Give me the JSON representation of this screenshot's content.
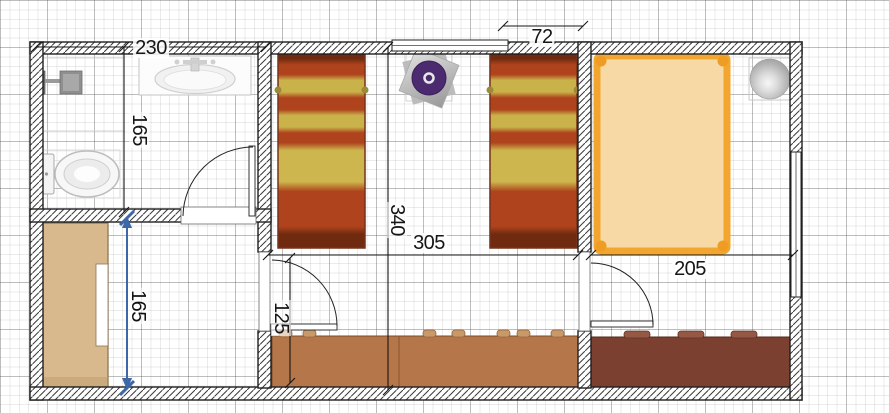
{
  "app": {
    "view": "floor-plan-editor-canvas",
    "grid": {
      "minor_step_px": 9.4,
      "major_step_px": 47,
      "shown": true
    }
  },
  "plan": {
    "dimensions": {
      "bathroom_width": "230",
      "bathroom_depth": "165",
      "window_to_wall": "72",
      "rooms_depth": "340",
      "middle_room_width": "305",
      "right_room_width": "205",
      "doorway_to_wall": "125",
      "storeroom_depth": "165"
    },
    "selected_dimension": "storeroom_depth",
    "colors": {
      "wall_outline": "#1f1f1f",
      "selected_dimension_line": "#3e67a8",
      "single_bed_stripe_red": "#ae431d",
      "single_bed_stripe_yellow": "#c9b24a",
      "single_bed_end": "#6f2a10",
      "double_bed_frame": "#f3a62f",
      "double_bed_fill": "#f6d9a4",
      "wardrobe_fill": "#d8b98e",
      "counter_left_fill": "#b5764a",
      "counter_right_fill": "#7c4030",
      "table_disc": "#4b2a70"
    },
    "furniture": [
      {
        "name": "shower-fixture"
      },
      {
        "name": "toilet"
      },
      {
        "name": "sink-counter"
      },
      {
        "name": "single-bed-1"
      },
      {
        "name": "single-bed-2"
      },
      {
        "name": "round-table"
      },
      {
        "name": "double-bed"
      },
      {
        "name": "ball-lamp"
      },
      {
        "name": "wardrobe"
      },
      {
        "name": "sideboard-left"
      },
      {
        "name": "sideboard-right"
      }
    ],
    "openings": [
      {
        "name": "window-top"
      },
      {
        "name": "window-right"
      },
      {
        "name": "door-bathroom"
      },
      {
        "name": "door-middle-room"
      },
      {
        "name": "door-right-room"
      }
    ]
  }
}
